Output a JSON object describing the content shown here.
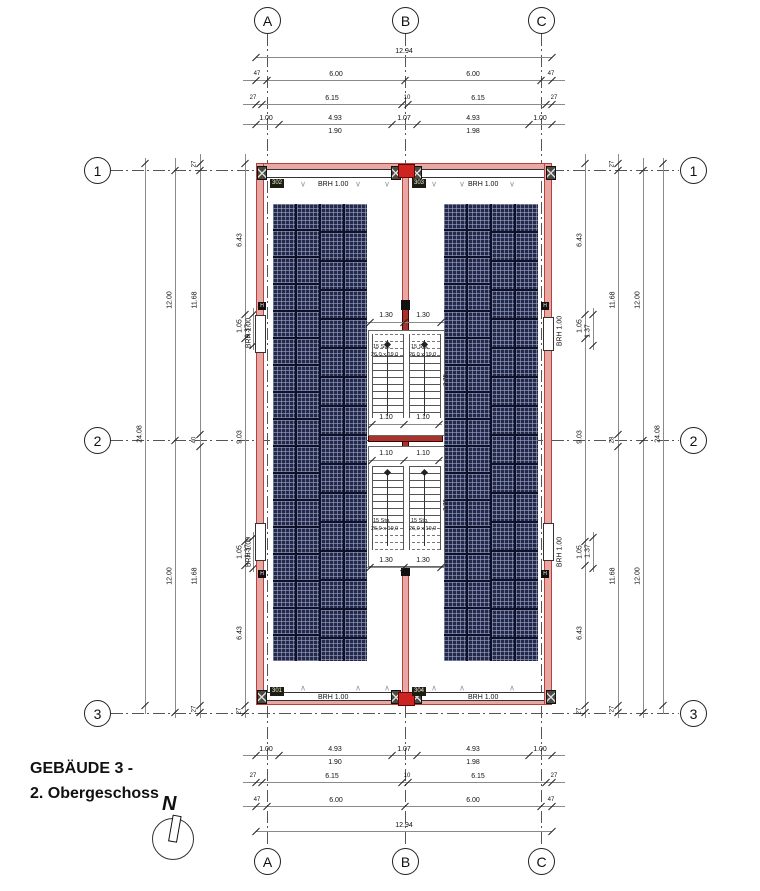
{
  "meta": {
    "title_line1": "GEBÄUDE 3 -",
    "title_line2": "2. Obergeschoss",
    "north_label": "N"
  },
  "colors": {
    "wall_fill": "#e8a7a2",
    "wall_edge": "#b5423a",
    "core_red": "#a5342c",
    "accent_red": "#cc2420",
    "panel_navy": "#232947",
    "dim_text": "#111111"
  },
  "axis": {
    "circles": [
      {
        "label": "A",
        "cx": 267,
        "cy": 20
      },
      {
        "label": "B",
        "cx": 405,
        "cy": 20
      },
      {
        "label": "C",
        "cx": 541,
        "cy": 20
      },
      {
        "label": "A",
        "cx": 267,
        "cy": 861
      },
      {
        "label": "B",
        "cx": 405,
        "cy": 861
      },
      {
        "label": "C",
        "cx": 541,
        "cy": 861
      },
      {
        "label": "1",
        "cx": 97,
        "cy": 170
      },
      {
        "label": "2",
        "cx": 97,
        "cy": 440
      },
      {
        "label": "3",
        "cx": 97,
        "cy": 713
      },
      {
        "label": "1",
        "cx": 693,
        "cy": 170
      },
      {
        "label": "2",
        "cx": 693,
        "cy": 440
      },
      {
        "label": "3",
        "cx": 693,
        "cy": 713
      }
    ],
    "vlines": [
      {
        "x": 267,
        "y1": 34,
        "y2": 847
      },
      {
        "x": 405,
        "y1": 34,
        "y2": 847
      },
      {
        "x": 541,
        "y1": 34,
        "y2": 847
      }
    ],
    "hlines": [
      {
        "y": 170,
        "x1": 111,
        "x2": 679
      },
      {
        "y": 440,
        "x1": 111,
        "x2": 679
      },
      {
        "y": 713,
        "x1": 111,
        "x2": 679
      }
    ]
  },
  "hdims": [
    {
      "y": 57,
      "x1": 256,
      "x2": 552,
      "ticks": [
        256,
        552
      ],
      "labels": [
        {
          "t": "12.94",
          "x": 404,
          "s": 7
        }
      ]
    },
    {
      "y": 80,
      "x1": 243,
      "x2": 565,
      "ticks": [
        256,
        267,
        405,
        541,
        552
      ],
      "labels": [
        {
          "t": "47",
          "x": 257,
          "s": 6
        },
        {
          "t": "6.00",
          "x": 336,
          "s": 7
        },
        {
          "t": "6.00",
          "x": 473,
          "s": 7
        },
        {
          "t": "47",
          "x": 551,
          "s": 6
        }
      ]
    },
    {
      "y": 104,
      "x1": 243,
      "x2": 565,
      "ticks": [
        256,
        262,
        402,
        408,
        546,
        552
      ],
      "labels": [
        {
          "t": "27",
          "x": 253,
          "s": 6
        },
        {
          "t": "6.15",
          "x": 332,
          "s": 7
        },
        {
          "t": "10",
          "x": 407,
          "s": 6
        },
        {
          "t": "6.15",
          "x": 478,
          "s": 7
        },
        {
          "t": "27",
          "x": 554,
          "s": 6
        }
      ]
    },
    {
      "y": 124,
      "x1": 243,
      "x2": 565,
      "ticks": [
        256,
        279,
        392,
        417,
        529,
        552
      ],
      "labels": [
        {
          "t": "1.00",
          "x": 266,
          "s": 7
        },
        {
          "t": "4.93",
          "x": 335,
          "s": 7
        },
        {
          "t": "1.07",
          "x": 404,
          "s": 7
        },
        {
          "t": "4.93",
          "x": 473,
          "s": 7
        },
        {
          "t": "1.00",
          "x": 540,
          "s": 7
        }
      ],
      "subs": [
        {
          "t": "1.90",
          "x": 335
        },
        {
          "t": "1.98",
          "x": 473
        }
      ]
    },
    {
      "y": 755,
      "x1": 243,
      "x2": 565,
      "ticks": [
        256,
        279,
        392,
        417,
        529,
        552
      ],
      "labels": [
        {
          "t": "1.00",
          "x": 266,
          "s": 7
        },
        {
          "t": "4.93",
          "x": 335,
          "s": 7
        },
        {
          "t": "1.07",
          "x": 404,
          "s": 7
        },
        {
          "t": "4.93",
          "x": 473,
          "s": 7
        },
        {
          "t": "1.00",
          "x": 540,
          "s": 7
        }
      ],
      "subs": [
        {
          "t": "1.90",
          "x": 335
        },
        {
          "t": "1.98",
          "x": 473
        }
      ]
    },
    {
      "y": 782,
      "x1": 243,
      "x2": 565,
      "ticks": [
        256,
        262,
        402,
        408,
        546,
        552
      ],
      "labels": [
        {
          "t": "27",
          "x": 253,
          "s": 6
        },
        {
          "t": "6.15",
          "x": 332,
          "s": 7
        },
        {
          "t": "10",
          "x": 407,
          "s": 6
        },
        {
          "t": "6.15",
          "x": 478,
          "s": 7
        },
        {
          "t": "27",
          "x": 554,
          "s": 6
        }
      ]
    },
    {
      "y": 806,
      "x1": 243,
      "x2": 565,
      "ticks": [
        256,
        267,
        405,
        541,
        552
      ],
      "labels": [
        {
          "t": "47",
          "x": 257,
          "s": 6
        },
        {
          "t": "6.00",
          "x": 336,
          "s": 7
        },
        {
          "t": "6.00",
          "x": 473,
          "s": 7
        },
        {
          "t": "47",
          "x": 551,
          "s": 6
        }
      ]
    },
    {
      "y": 831,
      "x1": 256,
      "x2": 552,
      "ticks": [
        256,
        552
      ],
      "labels": [
        {
          "t": "12.94",
          "x": 404,
          "s": 7
        }
      ]
    }
  ],
  "vdims": [
    {
      "x": 145,
      "y1": 158,
      "y2": 714,
      "ticks": [
        163,
        705
      ],
      "labels": [
        {
          "t": "24.08",
          "y": 434,
          "s": 7
        }
      ]
    },
    {
      "x": 175,
      "y1": 158,
      "y2": 718,
      "ticks": [
        170,
        440,
        712
      ],
      "labels": [
        {
          "t": "12.00",
          "y": 300,
          "s": 7
        },
        {
          "t": "12.00",
          "y": 576,
          "s": 7
        }
      ]
    },
    {
      "x": 200,
      "y1": 154,
      "y2": 718,
      "ticks": [
        163,
        170,
        434,
        446,
        705,
        712
      ],
      "labels": [
        {
          "t": "27",
          "y": 164,
          "s": 6
        },
        {
          "t": "11.68",
          "y": 300,
          "s": 7
        },
        {
          "t": "40",
          "y": 440,
          "s": 6
        },
        {
          "t": "11.68",
          "y": 576,
          "s": 7
        },
        {
          "t": "27",
          "y": 709,
          "s": 6
        }
      ]
    },
    {
      "x": 245,
      "y1": 154,
      "y2": 718,
      "ticks": [
        163,
        314,
        338,
        541,
        565,
        705,
        712
      ],
      "labels": [
        {
          "t": "6.43",
          "y": 240,
          "s": 7
        },
        {
          "t": "1.05",
          "y": 326,
          "s": 7
        },
        {
          "t": "9.03",
          "y": 437,
          "s": 7
        },
        {
          "t": "1.05",
          "y": 552,
          "s": 7
        },
        {
          "t": "6.43",
          "y": 633,
          "s": 7
        },
        {
          "t": "27",
          "y": 711,
          "s": 6
        }
      ]
    },
    {
      "x": 253,
      "y1": 308,
      "y2": 350,
      "ticks": [
        314,
        345
      ],
      "labels": [
        {
          "t": "1.37",
          "y": 331,
          "s": 7
        }
      ]
    },
    {
      "x": 253,
      "y1": 532,
      "y2": 572,
      "ticks": [
        537,
        568
      ],
      "labels": [
        {
          "t": "1.37",
          "y": 551,
          "s": 7
        }
      ]
    },
    {
      "x": 585,
      "y1": 154,
      "y2": 718,
      "ticks": [
        163,
        314,
        338,
        541,
        565,
        705,
        712
      ],
      "labels": [
        {
          "t": "6.43",
          "y": 240,
          "s": 7
        },
        {
          "t": "1.05",
          "y": 326,
          "s": 7
        },
        {
          "t": "9.03",
          "y": 437,
          "s": 7
        },
        {
          "t": "1.05",
          "y": 552,
          "s": 7
        },
        {
          "t": "6.43",
          "y": 633,
          "s": 7
        },
        {
          "t": "27",
          "y": 711,
          "s": 6
        }
      ]
    },
    {
      "x": 593,
      "y1": 308,
      "y2": 350,
      "ticks": [
        314,
        345
      ],
      "labels": [
        {
          "t": "1.37",
          "y": 331,
          "s": 7
        }
      ]
    },
    {
      "x": 593,
      "y1": 532,
      "y2": 572,
      "ticks": [
        537,
        568
      ],
      "labels": [
        {
          "t": "1.37",
          "y": 551,
          "s": 7
        }
      ]
    },
    {
      "x": 618,
      "y1": 154,
      "y2": 718,
      "ticks": [
        163,
        170,
        434,
        446,
        705,
        712
      ],
      "labels": [
        {
          "t": "27",
          "y": 164,
          "s": 6
        },
        {
          "t": "11.68",
          "y": 300,
          "s": 7
        },
        {
          "t": "28",
          "y": 440,
          "s": 6
        },
        {
          "t": "11.68",
          "y": 576,
          "s": 7
        },
        {
          "t": "27",
          "y": 709,
          "s": 6
        }
      ]
    },
    {
      "x": 643,
      "y1": 158,
      "y2": 718,
      "ticks": [
        170,
        440,
        712
      ],
      "labels": [
        {
          "t": "12.00",
          "y": 300,
          "s": 7
        },
        {
          "t": "12.00",
          "y": 576,
          "s": 7
        }
      ]
    },
    {
      "x": 663,
      "y1": 158,
      "y2": 714,
      "ticks": [
        163,
        705
      ],
      "labels": [
        {
          "t": "24.08",
          "y": 434,
          "s": 7
        }
      ]
    }
  ],
  "building": {
    "outer": {
      "x": 256,
      "y": 163,
      "w": 296,
      "h": 542
    },
    "walls": [
      {
        "x": 256,
        "y": 163,
        "w": 296,
        "h": 7
      },
      {
        "x": 256,
        "y": 698,
        "w": 296,
        "h": 7
      },
      {
        "x": 256,
        "y": 163,
        "w": 8,
        "h": 542
      },
      {
        "x": 544,
        "y": 163,
        "w": 8,
        "h": 542
      },
      {
        "x": 402,
        "y": 170,
        "w": 7,
        "h": 528
      }
    ],
    "inner_outline": {
      "x": 263,
      "y": 176,
      "w": 282,
      "h": 516
    },
    "window_bands": [
      {
        "x": 264,
        "y": 169,
        "w": 128,
        "h": 7
      },
      {
        "x": 416,
        "y": 169,
        "w": 128,
        "h": 7
      },
      {
        "x": 264,
        "y": 692,
        "w": 128,
        "h": 7
      },
      {
        "x": 416,
        "y": 692,
        "w": 128,
        "h": 7
      }
    ],
    "side_windows": [
      {
        "x": 255,
        "y": 315,
        "w": 9,
        "h": 36
      },
      {
        "x": 255,
        "y": 523,
        "w": 9,
        "h": 36
      },
      {
        "x": 543,
        "y": 317,
        "w": 9,
        "h": 32
      },
      {
        "x": 543,
        "y": 523,
        "w": 9,
        "h": 36
      }
    ],
    "xboxes": [
      {
        "x": 257,
        "y": 166,
        "w": 8,
        "h": 12
      },
      {
        "x": 546,
        "y": 166,
        "w": 8,
        "h": 12
      },
      {
        "x": 257,
        "y": 690,
        "w": 8,
        "h": 12
      },
      {
        "x": 546,
        "y": 690,
        "w": 8,
        "h": 12
      },
      {
        "x": 391,
        "y": 166,
        "w": 8,
        "h": 12
      },
      {
        "x": 412,
        "y": 166,
        "w": 8,
        "h": 12
      },
      {
        "x": 391,
        "y": 690,
        "w": 8,
        "h": 12
      },
      {
        "x": 412,
        "y": 690,
        "w": 8,
        "h": 12
      }
    ],
    "red_blocks": [
      {
        "x": 398,
        "y": 164,
        "w": 15,
        "h": 12
      },
      {
        "x": 398,
        "y": 692,
        "w": 15,
        "h": 12
      }
    ],
    "black_blocks": [
      {
        "x": 401,
        "y": 300,
        "w": 9,
        "h": 10
      },
      {
        "x": 401,
        "y": 566,
        "w": 9,
        "h": 10
      }
    ],
    "core_spine": {
      "x": 402,
      "y": 306,
      "w": 7,
      "h": 264
    },
    "cross_wall": {
      "x": 368,
      "y": 434,
      "w": 75,
      "h": 8
    },
    "h_markers": [
      {
        "x": 258,
        "y": 302
      },
      {
        "x": 258,
        "y": 570
      },
      {
        "x": 541,
        "y": 302
      },
      {
        "x": 541,
        "y": 570
      }
    ],
    "h_label": "H",
    "tags": [
      {
        "t": "302",
        "x": 270,
        "y": 179
      },
      {
        "t": "303",
        "x": 412,
        "y": 179
      },
      {
        "t": "301",
        "x": 270,
        "y": 687
      },
      {
        "t": "304",
        "x": 412,
        "y": 687
      }
    ],
    "brh_h": [
      {
        "t": "BRH 1.00",
        "x": 318,
        "y": 181
      },
      {
        "t": "BRH 1.00",
        "x": 468,
        "y": 181
      },
      {
        "t": "BRH 1.00",
        "x": 318,
        "y": 694
      },
      {
        "t": "BRH 1.00",
        "x": 468,
        "y": 694
      }
    ],
    "brh_v": [
      {
        "t": "BRH 1.00",
        "x": 249,
        "y": 333
      },
      {
        "t": "BRH 1.00",
        "x": 249,
        "y": 552
      },
      {
        "t": "BRH 1.00",
        "x": 560,
        "y": 331
      },
      {
        "t": "BRH 1.00",
        "x": 560,
        "y": 552
      }
    ],
    "win_marks": {
      "top_glyph": "∨",
      "bottom_glyph": "∧",
      "top_x": [
        303,
        358,
        387,
        434,
        462,
        512
      ],
      "top_y": 184,
      "bottom_x": [
        303,
        358,
        387,
        434,
        462,
        512
      ],
      "bottom_y": 688
    }
  },
  "panels": {
    "arrays": [
      {
        "x": 273,
        "y": 204,
        "h": 457
      },
      {
        "x": 444,
        "y": 204,
        "h": 457
      }
    ],
    "cols": 4,
    "col_w": 22,
    "col_gap": 2,
    "row_h_a": 25,
    "row_h_b": 27,
    "row_gap": 2
  },
  "stairs": {
    "upper": {
      "rect": {
        "x": 368,
        "y": 330,
        "w": 75,
        "h": 104
      },
      "flights": [
        {
          "x": 372,
          "y": 334,
          "w": 30,
          "h": 84
        },
        {
          "x": 409,
          "y": 334,
          "w": 30,
          "h": 84
        }
      ],
      "dash_at": "top",
      "dash_h": 22,
      "dim_a": {
        "y": 322,
        "ticks": [
          370,
          404,
          441
        ],
        "labels": [
          {
            "t": "1.30",
            "x": 386
          },
          {
            "t": "1.30",
            "x": 423
          }
        ],
        "label_dy": -3
      },
      "dim_b": {
        "y": 424,
        "ticks": [
          372,
          404,
          439
        ],
        "labels": [
          {
            "t": "1.10",
            "x": 386
          },
          {
            "t": "1.10",
            "x": 423
          }
        ],
        "label_dy": -3
      },
      "texts": [
        {
          "t": "15 Stg.",
          "x": 373,
          "y": 344
        },
        {
          "t": "26,0 x 19,0",
          "x": 371,
          "y": 352
        },
        {
          "t": "15 Stg.",
          "x": 411,
          "y": 344
        },
        {
          "t": "26,0 x 19,0",
          "x": 409,
          "y": 352
        }
      ],
      "vlabel": {
        "t": "2.75",
        "x": 447,
        "y": 380
      },
      "diamonds": [
        {
          "x": 387,
          "y": 344
        },
        {
          "x": 424,
          "y": 344
        }
      ],
      "walklines": [
        {
          "x": 387,
          "y1": 340,
          "y2": 416
        },
        {
          "x": 424,
          "y1": 340,
          "y2": 416
        }
      ]
    },
    "lower": {
      "rect": {
        "x": 368,
        "y": 446,
        "w": 75,
        "h": 119
      },
      "flights": [
        {
          "x": 372,
          "y": 466,
          "w": 30,
          "h": 84
        },
        {
          "x": 409,
          "y": 466,
          "w": 30,
          "h": 84
        }
      ],
      "dash_at": "bottom",
      "dash_h": 22,
      "dim_a": {
        "y": 460,
        "ticks": [
          372,
          404,
          439
        ],
        "labels": [
          {
            "t": "1.10",
            "x": 386
          },
          {
            "t": "1.10",
            "x": 423
          }
        ],
        "label_dy": -3
      },
      "dim_b": {
        "y": 567,
        "ticks": [
          370,
          404,
          441
        ],
        "labels": [
          {
            "t": "1.30",
            "x": 386
          },
          {
            "t": "1.30",
            "x": 423
          }
        ],
        "label_dy": -3
      },
      "texts": [
        {
          "t": "15 Stg.",
          "x": 373,
          "y": 518
        },
        {
          "t": "26,0 x 19,0",
          "x": 371,
          "y": 526
        },
        {
          "t": "15 Stg.",
          "x": 411,
          "y": 518
        },
        {
          "t": "26,0 x 19,0",
          "x": 409,
          "y": 526
        }
      ],
      "vlabel": {
        "t": "2.75",
        "x": 447,
        "y": 505
      },
      "diamonds": [
        {
          "x": 387,
          "y": 472
        },
        {
          "x": 424,
          "y": 472
        }
      ],
      "walklines": [
        {
          "x": 387,
          "y1": 470,
          "y2": 546
        },
        {
          "x": 424,
          "y1": 470,
          "y2": 546
        }
      ]
    }
  },
  "footer": {
    "title_x": 30,
    "title_y1": 760,
    "title_y2": 785,
    "north_circle": {
      "x": 152,
      "y": 818,
      "d": 40
    },
    "north_n": {
      "x": 162,
      "y": 795
    }
  }
}
